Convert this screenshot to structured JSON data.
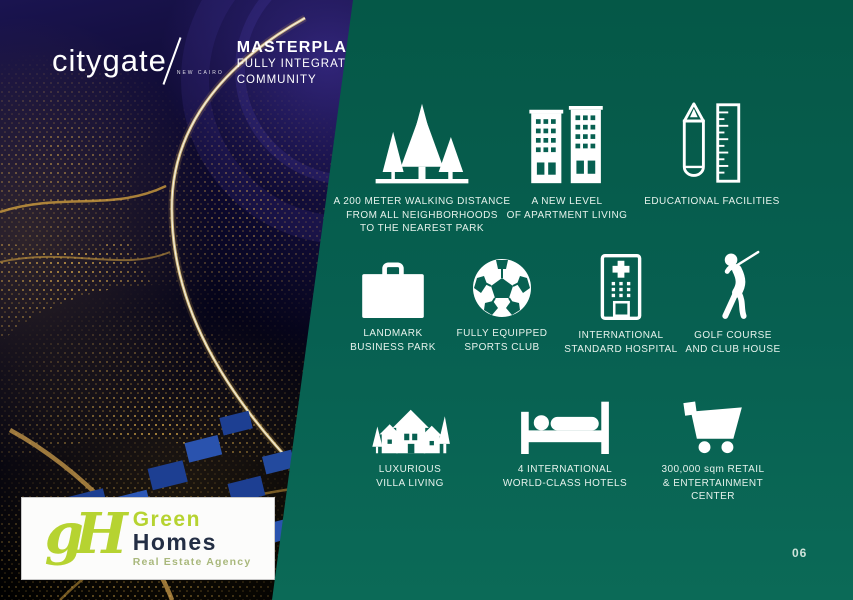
{
  "slide": {
    "page_number": "06",
    "colors": {
      "panel_green": "#076051",
      "icon_white": "#ffffff",
      "caption_text": "#e6f2ec",
      "lime_accent": "#b6d331",
      "logo_navy": "#232e44",
      "night_sky": "#0a0728",
      "city_lights_gold": "#e8b54d"
    }
  },
  "header": {
    "brand": "citygate",
    "brand_sub": "NEW CAIRO",
    "title": "MASTERPLAN",
    "subtitle_line1": "FULLY INTEGRATED",
    "subtitle_line2": "COMMUNITY"
  },
  "footer_logo": {
    "monogram": "gH",
    "name_line1": "Green",
    "name_line2": "Homes",
    "tagline": "Real Estate Agency"
  },
  "features": [
    {
      "icon": "park-trees-icon",
      "lines": [
        "A 200 METER WALKING DISTANCE",
        "FROM ALL NEIGHBORHOODS",
        "TO THE NEAREST PARK"
      ]
    },
    {
      "icon": "apartment-buildings-icon",
      "lines": [
        "A NEW LEVEL",
        "OF APARTMENT LIVING"
      ]
    },
    {
      "icon": "pencil-ruler-icon",
      "lines": [
        "EDUCATIONAL FACILITIES"
      ]
    },
    {
      "icon": "briefcase-icon",
      "lines": [
        "LANDMARK",
        "BUSINESS PARK"
      ]
    },
    {
      "icon": "soccer-ball-icon",
      "lines": [
        "FULLY EQUIPPED",
        "SPORTS CLUB"
      ]
    },
    {
      "icon": "hospital-icon",
      "lines": [
        "INTERNATIONAL",
        "STANDARD HOSPITAL"
      ]
    },
    {
      "icon": "golfer-icon",
      "lines": [
        "GOLF COURSE",
        "AND CLUB HOUSE"
      ]
    },
    {
      "icon": "villa-houses-icon",
      "lines": [
        "LUXURIOUS",
        "VILLA LIVING"
      ]
    },
    {
      "icon": "hotel-bed-icon",
      "lines": [
        "4 INTERNATIONAL",
        "WORLD-CLASS HOTELS"
      ]
    },
    {
      "icon": "shopping-cart-icon",
      "lines": [
        "300,000 sqm RETAIL",
        "& ENTERTAINMENT",
        "CENTER"
      ]
    }
  ]
}
